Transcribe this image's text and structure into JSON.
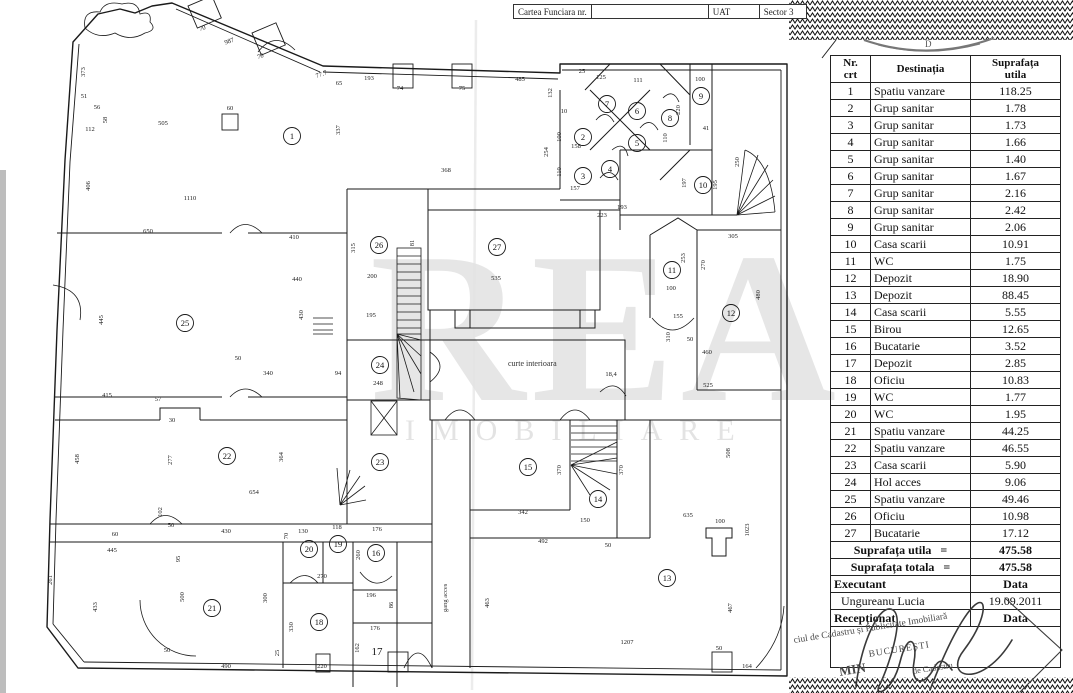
{
  "header": {
    "carte_funciara": "Cartea Funciara nr.",
    "uat": "UAT",
    "sector": "Sector 3"
  },
  "seal": {
    "letter": "D"
  },
  "table": {
    "headers": {
      "nr1": "Nr.",
      "nr2": "crt",
      "destinatia": "Destinația",
      "supr1": "Suprafața",
      "supr2": "utila"
    },
    "rows": [
      {
        "nr": "1",
        "dest": "Spatiu vanzare",
        "area": "118.25"
      },
      {
        "nr": "2",
        "dest": "Grup sanitar",
        "area": "1.78"
      },
      {
        "nr": "3",
        "dest": "Grup sanitar",
        "area": "1.73"
      },
      {
        "nr": "4",
        "dest": "Grup sanitar",
        "area": "1.66"
      },
      {
        "nr": "5",
        "dest": "Grup sanitar",
        "area": "1.40"
      },
      {
        "nr": "6",
        "dest": "Grup sanitar",
        "area": "1.67"
      },
      {
        "nr": "7",
        "dest": "Grup sanitar",
        "area": "2.16"
      },
      {
        "nr": "8",
        "dest": "Grup sanitar",
        "area": "2.42"
      },
      {
        "nr": "9",
        "dest": "Grup sanitar",
        "area": "2.06"
      },
      {
        "nr": "10",
        "dest": "Casa scarii",
        "area": "10.91"
      },
      {
        "nr": "11",
        "dest": "WC",
        "area": "1.75"
      },
      {
        "nr": "12",
        "dest": "Depozit",
        "area": "18.90"
      },
      {
        "nr": "13",
        "dest": "Depozit",
        "area": "88.45"
      },
      {
        "nr": "14",
        "dest": "Casa scarii",
        "area": "5.55"
      },
      {
        "nr": "15",
        "dest": "Birou",
        "area": "12.65"
      },
      {
        "nr": "16",
        "dest": "Bucatarie",
        "area": "3.52"
      },
      {
        "nr": "17",
        "dest": "Depozit",
        "area": "2.85"
      },
      {
        "nr": "18",
        "dest": "Oficiu",
        "area": "10.83"
      },
      {
        "nr": "19",
        "dest": "WC",
        "area": "1.77"
      },
      {
        "nr": "20",
        "dest": "WC",
        "area": "1.95"
      },
      {
        "nr": "21",
        "dest": "Spatiu vanzare",
        "area": "44.25"
      },
      {
        "nr": "22",
        "dest": "Spatiu vanzare",
        "area": "46.55"
      },
      {
        "nr": "23",
        "dest": "Casa scarii",
        "area": "5.90"
      },
      {
        "nr": "24",
        "dest": "Hol acces",
        "area": "9.06"
      },
      {
        "nr": "25",
        "dest": "Spatiu vanzare",
        "area": "49.46"
      },
      {
        "nr": "26",
        "dest": "Oficiu",
        "area": "10.98"
      },
      {
        "nr": "27",
        "dest": "Bucatarie",
        "area": "17.12"
      }
    ],
    "totals": [
      {
        "label": "Suprafața utila",
        "eq": "=",
        "value": "475.58"
      },
      {
        "label": "Suprafața totala",
        "eq": "=",
        "value": "475.58"
      }
    ],
    "executant_label": "Executant",
    "data_label": "Data",
    "executant_name": "Ungureanu  Lucia",
    "date": "19.09.2011",
    "receptionat_label": "Recepționat",
    "receptionat_data_label": "Data"
  },
  "stamp": {
    "line1": "ciul de Cadastru și Publicitate Imobiliară",
    "line2": "BUCUREȘTI",
    "line3": "MIN",
    "line4": "de Cadastru"
  },
  "plan": {
    "watermark_line1": "REA",
    "watermark_line2": "IMOBILIARE",
    "courtyard": "curte interioara",
    "passage": "gang acces",
    "rooms": [
      {
        "n": "1",
        "x": 292,
        "y": 136,
        "c": 1
      },
      {
        "n": "2",
        "x": 583,
        "y": 137,
        "c": 1
      },
      {
        "n": "3",
        "x": 583,
        "y": 176,
        "c": 1
      },
      {
        "n": "4",
        "x": 610,
        "y": 169,
        "c": 1
      },
      {
        "n": "5",
        "x": 637,
        "y": 143,
        "c": 1
      },
      {
        "n": "6",
        "x": 637,
        "y": 111,
        "c": 1
      },
      {
        "n": "7",
        "x": 607,
        "y": 104,
        "c": 1
      },
      {
        "n": "8",
        "x": 670,
        "y": 118,
        "c": 1
      },
      {
        "n": "9",
        "x": 701,
        "y": 96,
        "c": 1
      },
      {
        "n": "10",
        "x": 703,
        "y": 185,
        "c": 1
      },
      {
        "n": "11",
        "x": 672,
        "y": 270,
        "c": 1
      },
      {
        "n": "12",
        "x": 731,
        "y": 313,
        "c": 1
      },
      {
        "n": "13",
        "x": 667,
        "y": 578,
        "c": 1
      },
      {
        "n": "14",
        "x": 598,
        "y": 499,
        "c": 1
      },
      {
        "n": "15",
        "x": 528,
        "y": 467,
        "c": 1
      },
      {
        "n": "16",
        "x": 376,
        "y": 553,
        "c": 1
      },
      {
        "n": "17",
        "x": 377,
        "y": 652,
        "c": 0
      },
      {
        "n": "18",
        "x": 319,
        "y": 622,
        "c": 1
      },
      {
        "n": "19",
        "x": 338,
        "y": 544,
        "c": 1
      },
      {
        "n": "20",
        "x": 309,
        "y": 549,
        "c": 1
      },
      {
        "n": "21",
        "x": 212,
        "y": 608,
        "c": 1
      },
      {
        "n": "22",
        "x": 227,
        "y": 456,
        "c": 1
      },
      {
        "n": "23",
        "x": 380,
        "y": 462,
        "c": 1
      },
      {
        "n": "24",
        "x": 380,
        "y": 365,
        "c": 1
      },
      {
        "n": "25",
        "x": 185,
        "y": 323,
        "c": 1
      },
      {
        "n": "26",
        "x": 379,
        "y": 245,
        "c": 1
      },
      {
        "n": "27",
        "x": 497,
        "y": 247,
        "c": 1
      }
    ],
    "dims": [
      {
        "t": "373",
        "x": 85,
        "y": 72,
        "r": -90
      },
      {
        "t": "51",
        "x": 84,
        "y": 98
      },
      {
        "t": "56",
        "x": 97,
        "y": 109
      },
      {
        "t": "58",
        "x": 107,
        "y": 120,
        "r": -90
      },
      {
        "t": "112",
        "x": 90,
        "y": 131
      },
      {
        "t": "406",
        "x": 90,
        "y": 186,
        "r": -90
      },
      {
        "t": "505",
        "x": 163,
        "y": 125
      },
      {
        "t": "60",
        "x": 230,
        "y": 110
      },
      {
        "t": "1110",
        "x": 190,
        "y": 200
      },
      {
        "t": "650",
        "x": 148,
        "y": 233
      },
      {
        "t": "987",
        "x": 230,
        "y": 43,
        "r": -20
      },
      {
        "t": "70",
        "x": 203,
        "y": 30,
        "r": -20
      },
      {
        "t": "70",
        "x": 261,
        "y": 58,
        "r": -20
      },
      {
        "t": "77.7",
        "x": 322,
        "y": 76,
        "r": -20
      },
      {
        "t": "65",
        "x": 339,
        "y": 85
      },
      {
        "t": "193",
        "x": 369,
        "y": 80
      },
      {
        "t": "74",
        "x": 400,
        "y": 90
      },
      {
        "t": "75",
        "x": 462,
        "y": 90
      },
      {
        "t": "485",
        "x": 520,
        "y": 81
      },
      {
        "t": "25",
        "x": 582,
        "y": 73
      },
      {
        "t": "337",
        "x": 340,
        "y": 130,
        "r": -90
      },
      {
        "t": "368",
        "x": 446,
        "y": 172
      },
      {
        "t": "132",
        "x": 552,
        "y": 93,
        "r": -90
      },
      {
        "t": "10",
        "x": 564,
        "y": 113
      },
      {
        "t": "100",
        "x": 561,
        "y": 137,
        "r": -90
      },
      {
        "t": "254",
        "x": 548,
        "y": 152,
        "r": -90
      },
      {
        "t": "110",
        "x": 561,
        "y": 172,
        "r": -90
      },
      {
        "t": "125",
        "x": 601,
        "y": 79
      },
      {
        "t": "111",
        "x": 638,
        "y": 82
      },
      {
        "t": "100",
        "x": 700,
        "y": 81
      },
      {
        "t": "158",
        "x": 576,
        "y": 148
      },
      {
        "t": "157",
        "x": 575,
        "y": 190
      },
      {
        "t": "110",
        "x": 667,
        "y": 138,
        "r": -90
      },
      {
        "t": "220",
        "x": 680,
        "y": 110,
        "r": -90
      },
      {
        "t": "41",
        "x": 706,
        "y": 130
      },
      {
        "t": "197",
        "x": 686,
        "y": 183,
        "r": -90
      },
      {
        "t": "195",
        "x": 717,
        "y": 185,
        "r": -90
      },
      {
        "t": "250",
        "x": 739,
        "y": 162,
        "r": -90
      },
      {
        "t": "193",
        "x": 622,
        "y": 209
      },
      {
        "t": "223",
        "x": 602,
        "y": 217
      },
      {
        "t": "305",
        "x": 733,
        "y": 238
      },
      {
        "t": "253",
        "x": 685,
        "y": 258,
        "r": -90
      },
      {
        "t": "270",
        "x": 705,
        "y": 265,
        "r": -90
      },
      {
        "t": "480",
        "x": 760,
        "y": 295,
        "r": -90
      },
      {
        "t": "100",
        "x": 671,
        "y": 290
      },
      {
        "t": "155",
        "x": 678,
        "y": 318
      },
      {
        "t": "310",
        "x": 670,
        "y": 337,
        "r": -90
      },
      {
        "t": "460",
        "x": 707,
        "y": 354
      },
      {
        "t": "50",
        "x": 690,
        "y": 341
      },
      {
        "t": "525",
        "x": 708,
        "y": 387
      },
      {
        "t": "535",
        "x": 496,
        "y": 280
      },
      {
        "t": "200",
        "x": 372,
        "y": 278
      },
      {
        "t": "81",
        "x": 414,
        "y": 243,
        "r": -90
      },
      {
        "t": "195",
        "x": 371,
        "y": 317
      },
      {
        "t": "315",
        "x": 355,
        "y": 248,
        "r": -90
      },
      {
        "t": "248",
        "x": 378,
        "y": 385
      },
      {
        "t": "18,4",
        "x": 611,
        "y": 376
      },
      {
        "t": "410",
        "x": 294,
        "y": 239
      },
      {
        "t": "440",
        "x": 297,
        "y": 281
      },
      {
        "t": "430",
        "x": 303,
        "y": 315,
        "r": -90
      },
      {
        "t": "340",
        "x": 268,
        "y": 375
      },
      {
        "t": "94",
        "x": 338,
        "y": 375
      },
      {
        "t": "50",
        "x": 238,
        "y": 360
      },
      {
        "t": "445",
        "x": 103,
        "y": 320,
        "r": -90
      },
      {
        "t": "415",
        "x": 107,
        "y": 397
      },
      {
        "t": "57",
        "x": 158,
        "y": 401
      },
      {
        "t": "30",
        "x": 172,
        "y": 422
      },
      {
        "t": "458",
        "x": 79,
        "y": 459,
        "r": -90
      },
      {
        "t": "277",
        "x": 172,
        "y": 460,
        "r": -90
      },
      {
        "t": "364",
        "x": 283,
        "y": 457,
        "r": -90
      },
      {
        "t": "654",
        "x": 254,
        "y": 494
      },
      {
        "t": "50",
        "x": 171,
        "y": 527
      },
      {
        "t": "102",
        "x": 162,
        "y": 512,
        "r": -90
      },
      {
        "t": "60",
        "x": 115,
        "y": 536
      },
      {
        "t": "445",
        "x": 112,
        "y": 552
      },
      {
        "t": "95",
        "x": 180,
        "y": 559,
        "r": -90
      },
      {
        "t": "430",
        "x": 226,
        "y": 533
      },
      {
        "t": "70",
        "x": 288,
        "y": 536,
        "r": -90
      },
      {
        "t": "130",
        "x": 303,
        "y": 533
      },
      {
        "t": "118",
        "x": 337,
        "y": 529
      },
      {
        "t": "176",
        "x": 377,
        "y": 531
      },
      {
        "t": "260",
        "x": 360,
        "y": 555,
        "r": -90
      },
      {
        "t": "270",
        "x": 322,
        "y": 578
      },
      {
        "t": "196",
        "x": 371,
        "y": 597
      },
      {
        "t": "86",
        "x": 393,
        "y": 605,
        "r": -90
      },
      {
        "t": "176",
        "x": 375,
        "y": 630
      },
      {
        "t": "162",
        "x": 359,
        "y": 648,
        "r": -90
      },
      {
        "t": "330",
        "x": 293,
        "y": 627,
        "r": -90
      },
      {
        "t": "300",
        "x": 267,
        "y": 598,
        "r": -90
      },
      {
        "t": "500",
        "x": 184,
        "y": 597,
        "r": -90
      },
      {
        "t": "433",
        "x": 97,
        "y": 607,
        "r": -90
      },
      {
        "t": "261",
        "x": 52,
        "y": 580,
        "r": -90
      },
      {
        "t": "490",
        "x": 226,
        "y": 668
      },
      {
        "t": "50",
        "x": 167,
        "y": 652
      },
      {
        "t": "220",
        "x": 322,
        "y": 668
      },
      {
        "t": "25",
        "x": 279,
        "y": 653,
        "r": -90
      },
      {
        "t": "342",
        "x": 523,
        "y": 514
      },
      {
        "t": "492",
        "x": 543,
        "y": 543
      },
      {
        "t": "150",
        "x": 585,
        "y": 522
      },
      {
        "t": "50",
        "x": 608,
        "y": 547
      },
      {
        "t": "370",
        "x": 561,
        "y": 470,
        "r": -90
      },
      {
        "t": "370",
        "x": 623,
        "y": 470,
        "r": -90
      },
      {
        "t": "635",
        "x": 688,
        "y": 517
      },
      {
        "t": "100",
        "x": 720,
        "y": 523
      },
      {
        "t": "1023",
        "x": 749,
        "y": 530,
        "r": -90
      },
      {
        "t": "508",
        "x": 730,
        "y": 453,
        "r": -90
      },
      {
        "t": "1207",
        "x": 627,
        "y": 644
      },
      {
        "t": "467",
        "x": 732,
        "y": 608,
        "r": -90
      },
      {
        "t": "164",
        "x": 747,
        "y": 668
      },
      {
        "t": "50",
        "x": 719,
        "y": 650
      },
      {
        "t": "463",
        "x": 489,
        "y": 603,
        "r": -90
      }
    ]
  }
}
